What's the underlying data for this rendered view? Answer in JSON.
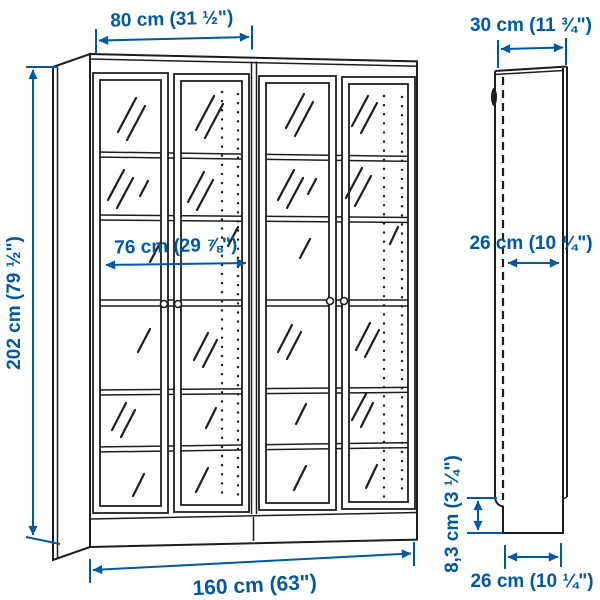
{
  "colors": {
    "dimension_blue": "#0058A3",
    "line_black": "#1d1d1b",
    "background": "#ffffff"
  },
  "views": {
    "front": {
      "name": "bookcase front view"
    },
    "side": {
      "name": "side panel depth view"
    }
  },
  "dimensions": {
    "front_top_width": "80 cm (31 ½\")",
    "front_height": "202 cm (79 ½\")",
    "front_inner_width": "76 cm (29 ⅞\")",
    "front_total_width": "160 cm (63\")",
    "side_top_depth": "30 cm (11 ¾\")",
    "side_inner_depth": "26 cm (10 ¼\")",
    "side_plinth_height": "8,3 cm (3 ¼\")",
    "side_bottom_depth": "26 cm (10 ¼\")"
  }
}
